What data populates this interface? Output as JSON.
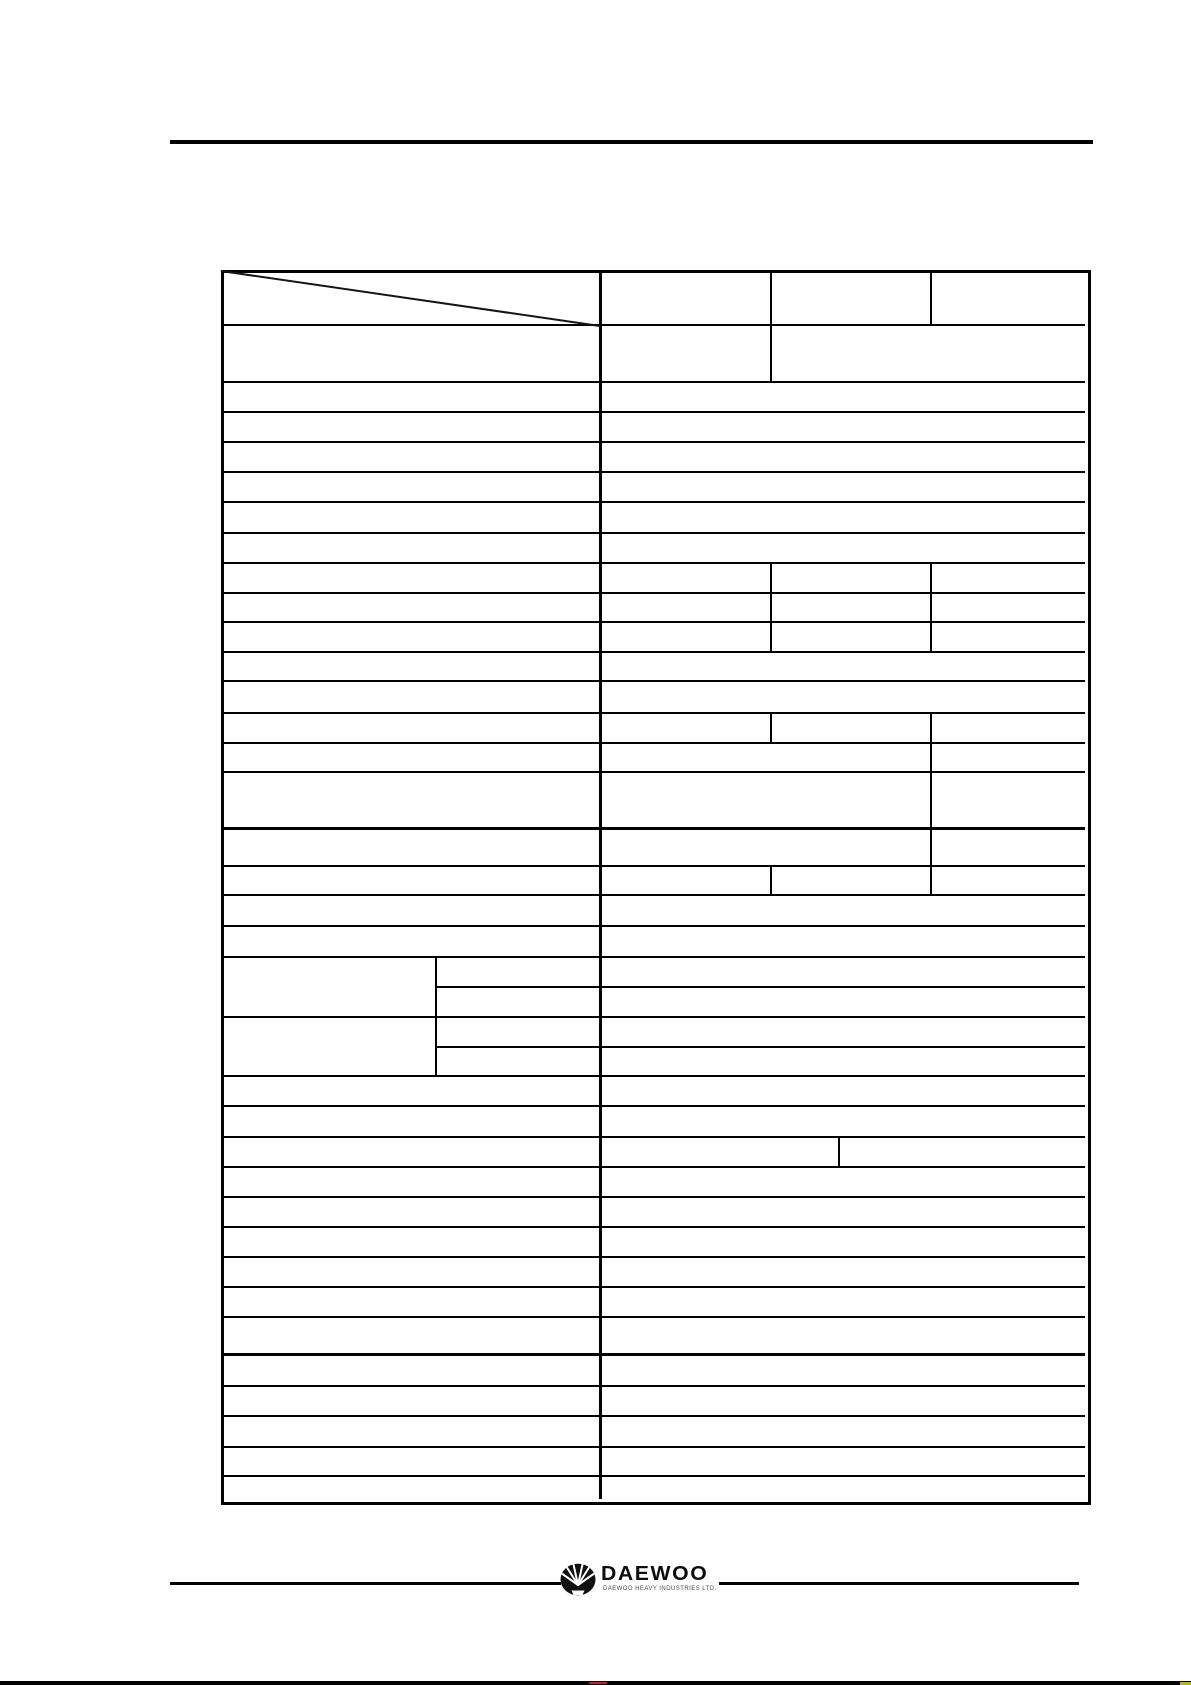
{
  "page": {
    "paper_color": "#ffffff",
    "ink_color": "#000000"
  },
  "table": {
    "content": "",
    "rows_visible": 38,
    "header_diagonal_cell": true
  },
  "footer": {
    "brand_wordmark": "DAEWOO",
    "brand_subtext": "DAEWOO HEAVY INDUSTRIES LTD.",
    "emblem_icon": "daewoo-crest-icon"
  },
  "colors": {
    "rule": "#000000",
    "bottom_mark_red": "#bb2626",
    "bottom_mark_yellow": "#b6b620"
  }
}
